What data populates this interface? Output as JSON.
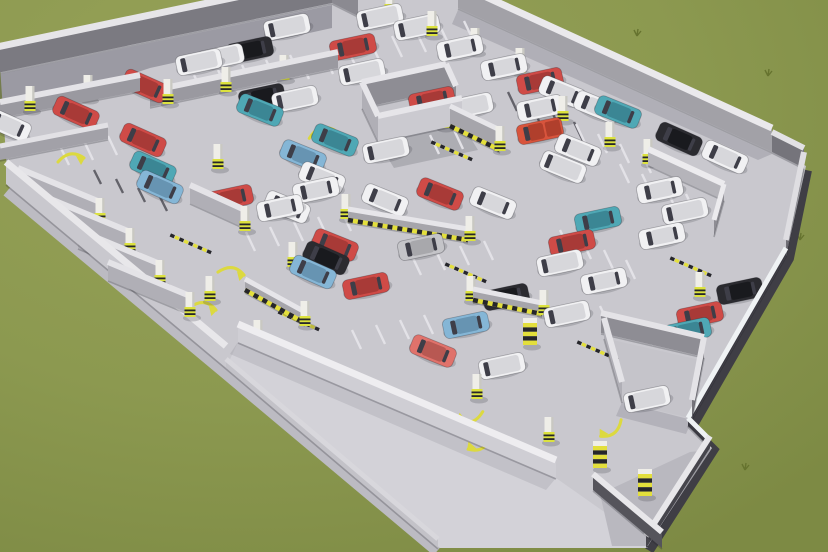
{
  "scene": {
    "kind": "3d-render-parking-garage",
    "canvas": {
      "w": 828,
      "h": 552
    },
    "palette": {
      "grass_light": "#97a258",
      "grass_base": "#8c9950",
      "grass_dark": "#7d8a44",
      "floor": "#c9c8ce",
      "floor_light": "#d3d2d8",
      "floor_room": "#c5c4ca",
      "ramp": "#b9b8bf",
      "plinth_light": "#bcbbc2",
      "plinth_dark": "#3f3e45",
      "hazard_yellow": "#e3df3c",
      "hazard_black": "#26262b",
      "pillar_body": "#efeee8",
      "pillar_base": "#dce23e",
      "marking_yellow": "#dcd93f",
      "tick_light": "#e3e2e7",
      "tick_dark": "#63626a",
      "shadow": "#32323e",
      "window": "#3e3e48"
    },
    "car_colors": {
      "red": [
        "#cf4b47",
        "#a83a37"
      ],
      "salmon": [
        "#e0726b",
        "#b85852"
      ],
      "teal": [
        "#4fa8b5",
        "#3b8694"
      ],
      "skyblue": [
        "#85b6d6",
        "#6794b2"
      ],
      "blue": [
        "#4a79b8",
        "#385f96"
      ],
      "black": [
        "#2b2b30",
        "#191a1e"
      ],
      "white": [
        "#f1f1f3",
        "#d7d7db"
      ],
      "silver": [
        "#c4c4c8",
        "#a8a8ac"
      ],
      "truck": [
        "#d8543c",
        "#b03f2c"
      ]
    },
    "footprint": [
      [
        0,
        66
      ],
      [
        318,
        0
      ],
      [
        468,
        0
      ],
      [
        772,
        148
      ],
      [
        806,
        166
      ],
      [
        786,
        256
      ],
      [
        688,
        426
      ],
      [
        712,
        448
      ],
      [
        646,
        548
      ],
      [
        440,
        548
      ],
      [
        226,
        368
      ],
      [
        8,
        186
      ]
    ],
    "apron": [
      [
        238,
        342
      ],
      [
        556,
        478
      ],
      [
        610,
        516
      ],
      [
        648,
        548
      ],
      [
        440,
        548
      ],
      [
        226,
        368
      ]
    ],
    "ramp_floor": [
      [
        600,
        494
      ],
      [
        690,
        452
      ],
      [
        708,
        450
      ],
      [
        648,
        546
      ],
      [
        612,
        546
      ]
    ],
    "core_floor": [
      [
        362,
        108
      ],
      [
        446,
        90
      ],
      [
        462,
        124
      ],
      [
        378,
        142
      ]
    ],
    "enclosure_floor": [
      [
        604,
        338
      ],
      [
        700,
        360
      ],
      [
        690,
        418
      ],
      [
        622,
        402
      ]
    ],
    "plinth_light_path": [
      [
        8,
        190
      ],
      [
        226,
        372
      ],
      [
        438,
        550
      ]
    ],
    "plinth_dark_path": [
      [
        806,
        170
      ],
      [
        788,
        258
      ],
      [
        690,
        428
      ],
      [
        712,
        450
      ],
      [
        648,
        550
      ]
    ],
    "shadows": [
      {
        "pts": [
          [
            0,
            74
          ],
          [
            332,
            5
          ],
          [
            332,
            28
          ],
          [
            150,
            68
          ],
          [
            0,
            118
          ]
        ],
        "a": 0.3
      },
      {
        "pts": [
          [
            458,
            10
          ],
          [
            772,
            154
          ],
          [
            758,
            160
          ],
          [
            452,
            24
          ]
        ],
        "a": 0.16
      },
      {
        "pts": [
          [
            6,
            184
          ],
          [
            226,
            368
          ],
          [
            244,
            376
          ],
          [
            24,
            192
          ]
        ],
        "a": 0.12
      },
      {
        "pts": [
          [
            378,
            142
          ],
          [
            462,
            124
          ],
          [
            478,
            150
          ],
          [
            394,
            168
          ]
        ],
        "a": 0.18
      },
      {
        "pts": [
          [
            622,
            402
          ],
          [
            692,
            420
          ],
          [
            686,
            434
          ],
          [
            616,
            416
          ]
        ],
        "a": 0.14
      },
      {
        "pts": [
          [
            238,
            342
          ],
          [
            556,
            478
          ],
          [
            546,
            490
          ],
          [
            230,
            354
          ]
        ],
        "a": 0.1
      }
    ],
    "walls": [
      [
        -8,
        74,
        332,
        3,
        26,
        7,
        "#e6e5e8",
        "#7b7a81",
        0
      ],
      [
        332,
        3,
        358,
        16,
        22,
        6,
        "#e2e1e4",
        "#8b8a91",
        0
      ],
      [
        458,
        8,
        772,
        152,
        24,
        7,
        "#eae9ec",
        "#a2a1a7",
        0
      ],
      [
        772,
        152,
        804,
        168,
        20,
        6,
        "#e2e1e4",
        "#75747b",
        0
      ],
      [
        804,
        168,
        786,
        256,
        16,
        6,
        "#dfdee2",
        "#6f6e75",
        0
      ],
      [
        786,
        256,
        688,
        426,
        8,
        5,
        "#eff2f4",
        "#3a3941",
        0
      ],
      [
        688,
        426,
        710,
        448,
        8,
        5,
        "#eff2f4",
        "#3a3941",
        0
      ],
      [
        710,
        448,
        646,
        548,
        12,
        6,
        "#e8e7ea",
        "#46454c",
        0
      ],
      [
        6,
        184,
        226,
        368,
        22,
        7,
        "#e8e7ea",
        "#c9c8ce",
        0
      ],
      [
        238,
        342,
        556,
        478,
        18,
        7,
        "#eeedf0",
        "#cfced4",
        0
      ],
      [
        226,
        368,
        438,
        548,
        9,
        5,
        "#d8d7dc",
        "#c3c2c8",
        0
      ],
      [
        593,
        490,
        662,
        548,
        16,
        6,
        "#e8e7ea",
        "#55545b",
        0
      ],
      [
        0,
        118,
        140,
        91,
        16,
        6,
        "#e4e3e7",
        "#9a99a0",
        0
      ],
      [
        0,
        160,
        108,
        139,
        14,
        5,
        "#e2e1e5",
        "#a2a1a8",
        0
      ],
      [
        150,
        107,
        338,
        68,
        16,
        6,
        "#e4e3e7",
        "#9a99a0",
        0
      ],
      [
        18,
        186,
        100,
        220,
        18,
        6,
        "#e4e3e7",
        "#b0afb6",
        0
      ],
      [
        48,
        216,
        130,
        250,
        18,
        6,
        "#e4e3e7",
        "#b0afb6",
        0
      ],
      [
        78,
        248,
        160,
        282,
        18,
        6,
        "#e4e3e7",
        "#b0afb6",
        0
      ],
      [
        108,
        280,
        190,
        314,
        18,
        6,
        "#e4e3e7",
        "#b0afb6",
        0
      ],
      [
        190,
        203,
        245,
        228,
        18,
        6,
        "#e4e3e7",
        "#b0afb6",
        0
      ],
      [
        362,
        108,
        446,
        90,
        26,
        6,
        "#e6e5e9",
        "#8e8d94",
        0
      ],
      [
        362,
        108,
        378,
        142,
        26,
        6,
        "#e6e5e9",
        "#b0afb6",
        0
      ],
      [
        378,
        142,
        462,
        124,
        26,
        6,
        "#e6e5e9",
        "#cbcad0",
        0
      ],
      [
        446,
        90,
        456,
        112,
        26,
        6,
        "#e6e5e9",
        "#8e8d94",
        0
      ],
      [
        450,
        128,
        500,
        152,
        22,
        5,
        "#e6e5e9",
        "#a6a5ab",
        1
      ],
      [
        648,
        165,
        724,
        200,
        16,
        6,
        "#ecebee",
        "#b5b4ba",
        0
      ],
      [
        724,
        200,
        714,
        236,
        16,
        5,
        "#ecebee",
        "#8e8d94",
        0
      ],
      [
        601,
        333,
        704,
        357,
        20,
        6,
        "#e4e3e7",
        "#8e8d94",
        0
      ],
      [
        604,
        338,
        622,
        402,
        20,
        6,
        "#e4e3e7",
        "#b0afb6",
        0
      ],
      [
        704,
        357,
        692,
        420,
        20,
        6,
        "#e4e3e7",
        "#75747b",
        0
      ],
      [
        348,
        222,
        468,
        242,
        13,
        5,
        "#e6e5e9",
        "#a6a5ab",
        1
      ],
      [
        245,
        292,
        305,
        325,
        13,
        5,
        "#e6e5e9",
        "#a6a5ab",
        1
      ],
      [
        473,
        302,
        542,
        316,
        13,
        5,
        "#e6e5e9",
        "#a6a5ab",
        1
      ]
    ],
    "pillars": [
      [
        390,
        13,
        0
      ],
      [
        432,
        35,
        0
      ],
      [
        475,
        52,
        0
      ],
      [
        520,
        72,
        0
      ],
      [
        30,
        110,
        0
      ],
      [
        88,
        99,
        0
      ],
      [
        168,
        103,
        0
      ],
      [
        226,
        91,
        0
      ],
      [
        284,
        79,
        0
      ],
      [
        218,
        168,
        0
      ],
      [
        100,
        222,
        0
      ],
      [
        130,
        252,
        0
      ],
      [
        160,
        284,
        0
      ],
      [
        190,
        316,
        0
      ],
      [
        245,
        230,
        0
      ],
      [
        293,
        266,
        0
      ],
      [
        210,
        300,
        0
      ],
      [
        258,
        344,
        0
      ],
      [
        346,
        218,
        0
      ],
      [
        470,
        240,
        0
      ],
      [
        305,
        325,
        0
      ],
      [
        471,
        300,
        0
      ],
      [
        544,
        314,
        0
      ],
      [
        444,
        127,
        0
      ],
      [
        500,
        150,
        0
      ],
      [
        563,
        120,
        0
      ],
      [
        610,
        146,
        0
      ],
      [
        648,
        163,
        0
      ],
      [
        700,
        296,
        0
      ],
      [
        530,
        345,
        1
      ],
      [
        477,
        398,
        0
      ],
      [
        549,
        441,
        0
      ],
      [
        600,
        468,
        1
      ],
      [
        645,
        496,
        1
      ]
    ],
    "cars": [
      [
        199,
        62,
        -12,
        "white",
        1
      ],
      [
        221,
        57,
        -12,
        "white",
        1
      ],
      [
        250,
        50,
        -12,
        "black",
        0
      ],
      [
        287,
        27,
        -12,
        "white",
        1
      ],
      [
        380,
        17,
        -12,
        "white",
        1
      ],
      [
        362,
        72,
        -12,
        "white",
        1
      ],
      [
        262,
        97,
        -12,
        "black",
        0
      ],
      [
        295,
        99,
        -12,
        "white",
        1
      ],
      [
        353,
        47,
        -12,
        "red",
        0
      ],
      [
        417,
        27,
        -12,
        "white",
        1
      ],
      [
        460,
        48,
        -12,
        "white",
        0
      ],
      [
        504,
        67,
        -12,
        "white",
        0
      ],
      [
        540,
        81,
        -12,
        "red",
        0
      ],
      [
        540,
        108,
        -12,
        "white",
        0
      ],
      [
        540,
        131,
        -12,
        "truck",
        2
      ],
      [
        145,
        86,
        24,
        "red",
        0
      ],
      [
        76,
        113,
        24,
        "red",
        0
      ],
      [
        143,
        140,
        24,
        "red",
        0
      ],
      [
        153,
        168,
        24,
        "teal",
        0
      ],
      [
        160,
        187,
        24,
        "skyblue",
        0
      ],
      [
        8,
        125,
        24,
        "white",
        0
      ],
      [
        260,
        110,
        22,
        "teal",
        0
      ],
      [
        419,
        91,
        22,
        "teal",
        0
      ],
      [
        432,
        100,
        -12,
        "red",
        0
      ],
      [
        470,
        106,
        -12,
        "white",
        1
      ],
      [
        335,
        140,
        22,
        "teal",
        0
      ],
      [
        303,
        156,
        22,
        "skyblue",
        0
      ],
      [
        386,
        150,
        -12,
        "white",
        1
      ],
      [
        322,
        178,
        22,
        "white",
        0
      ],
      [
        316,
        190,
        -12,
        "white",
        0
      ],
      [
        287,
        207,
        22,
        "white",
        0
      ],
      [
        385,
        200,
        22,
        "white",
        0
      ],
      [
        230,
        198,
        -12,
        "red",
        0
      ],
      [
        280,
        208,
        -12,
        "white",
        0
      ],
      [
        440,
        194,
        22,
        "red",
        0
      ],
      [
        493,
        203,
        22,
        "white",
        0
      ],
      [
        421,
        247,
        -12,
        "silver",
        0
      ],
      [
        335,
        245,
        22,
        "red",
        0
      ],
      [
        326,
        258,
        24,
        "black",
        0
      ],
      [
        313,
        272,
        24,
        "skyblue",
        0
      ],
      [
        366,
        286,
        -12,
        "red",
        0
      ],
      [
        506,
        297,
        -12,
        "black",
        0
      ],
      [
        466,
        325,
        -12,
        "skyblue",
        0
      ],
      [
        433,
        351,
        22,
        "salmon",
        0
      ],
      [
        502,
        366,
        -12,
        "white",
        1
      ],
      [
        562,
        92,
        22,
        "white",
        0
      ],
      [
        597,
        107,
        22,
        "white",
        0
      ],
      [
        618,
        112,
        22,
        "teal",
        0
      ],
      [
        679,
        139,
        24,
        "black",
        0
      ],
      [
        725,
        157,
        24,
        "white",
        0
      ],
      [
        578,
        150,
        22,
        "white",
        0
      ],
      [
        563,
        167,
        22,
        "white",
        1
      ],
      [
        660,
        190,
        -12,
        "white",
        0
      ],
      [
        685,
        211,
        -12,
        "white",
        1
      ],
      [
        662,
        236,
        -12,
        "white",
        0
      ],
      [
        598,
        220,
        -12,
        "teal",
        0
      ],
      [
        572,
        243,
        -12,
        "red",
        0
      ],
      [
        560,
        263,
        -12,
        "white",
        1
      ],
      [
        604,
        281,
        -12,
        "white",
        0
      ],
      [
        567,
        314,
        -12,
        "white",
        1
      ],
      [
        740,
        291,
        -12,
        "black",
        0
      ],
      [
        700,
        315,
        -12,
        "red",
        0
      ],
      [
        688,
        331,
        -12,
        "teal",
        0
      ],
      [
        647,
        399,
        -12,
        "white",
        1
      ]
    ],
    "tick_rows": [
      [
        170,
        80,
        6,
        24,
        -5,
        10,
        21,
        "l"
      ],
      [
        392,
        36,
        4,
        24,
        -5,
        10,
        21,
        "l"
      ],
      [
        508,
        92,
        4,
        22,
        10,
        9,
        19,
        "d"
      ],
      [
        226,
        6,
        4,
        24,
        -5,
        8,
        16,
        "d"
      ],
      [
        60,
        146,
        4,
        24,
        -5,
        9,
        19,
        "l"
      ],
      [
        94,
        170,
        4,
        22,
        9,
        7,
        14,
        "d"
      ],
      [
        246,
        232,
        5,
        24,
        -5,
        9,
        19,
        "l"
      ],
      [
        412,
        256,
        4,
        24,
        -5,
        9,
        19,
        "l"
      ],
      [
        352,
        330,
        4,
        24,
        -5,
        9,
        19,
        "l"
      ],
      [
        576,
        124,
        4,
        22,
        10,
        9,
        19,
        "l"
      ],
      [
        620,
        164,
        4,
        22,
        10,
        9,
        19,
        "l"
      ],
      [
        560,
        230,
        4,
        22,
        10,
        9,
        19,
        "l"
      ],
      [
        600,
        306,
        3,
        22,
        10,
        9,
        19,
        "l"
      ],
      [
        300,
        60,
        4,
        24,
        -5,
        9,
        19,
        "l"
      ],
      [
        430,
        135,
        3,
        24,
        -5,
        9,
        19,
        "l"
      ]
    ],
    "speed_bumps": [
      [
        465,
        272
      ],
      [
        298,
        320
      ],
      [
        690,
        266
      ],
      [
        451,
        150
      ],
      [
        190,
        243
      ],
      [
        418,
        400
      ],
      [
        597,
        350
      ]
    ],
    "floor_arrows": [
      [
        322,
        130,
        -10
      ],
      [
        233,
        270,
        15
      ],
      [
        205,
        305,
        15
      ],
      [
        470,
        420,
        170
      ],
      [
        480,
        447,
        160
      ],
      [
        612,
        432,
        150
      ],
      [
        72,
        156,
        0
      ]
    ],
    "grass_tufts": [
      [
        683,
        103
      ],
      [
        724,
        117
      ],
      [
        768,
        76
      ],
      [
        637,
        36
      ],
      [
        800,
        240
      ],
      [
        745,
        470
      ]
    ]
  }
}
